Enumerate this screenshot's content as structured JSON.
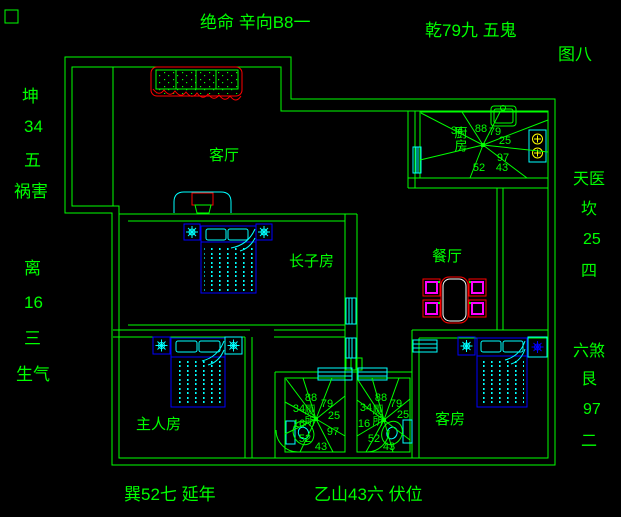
{
  "annotations": {
    "top": [
      "绝命 辛向B8一",
      "乾79九 五鬼"
    ],
    "figure_no": "图八",
    "left": [
      "坤",
      "34",
      "五",
      "祸害",
      "离",
      "16",
      "三",
      "生气"
    ],
    "right": [
      "天医",
      "坎",
      "25",
      "四",
      "六煞",
      "艮",
      "97",
      "二"
    ],
    "bottom": [
      "巽52七 延年",
      "乙山43六 伏位"
    ]
  },
  "rooms": {
    "living_room": "客厅",
    "eldest_son_room": "长子房",
    "dining_room": "餐厅",
    "master_room": "主人房",
    "guest_room": "客房",
    "kitchen": "厨房",
    "bathroom_left": "厕所",
    "bathroom_right": "厕所"
  },
  "compasses": {
    "kitchen": [
      "34",
      "88",
      "79",
      "25",
      "97",
      "43",
      "52"
    ],
    "bath_left": [
      "88",
      "79",
      "34",
      "25",
      "16",
      "97",
      "52",
      "43"
    ],
    "bath_right": [
      "88",
      "79",
      "34",
      "25",
      "16",
      "52",
      "43"
    ]
  },
  "colors": {
    "line": "#00ff00",
    "accent_red": "#ff0000",
    "fixture_cyan": "#00ffff",
    "furniture_blue": "#0000ff",
    "figure_blue": "#2a2aff",
    "chair_magenta": "#ff00ff",
    "burner_yellow": "#ffff00",
    "table_white": "#ffffff",
    "background": "#000000"
  }
}
